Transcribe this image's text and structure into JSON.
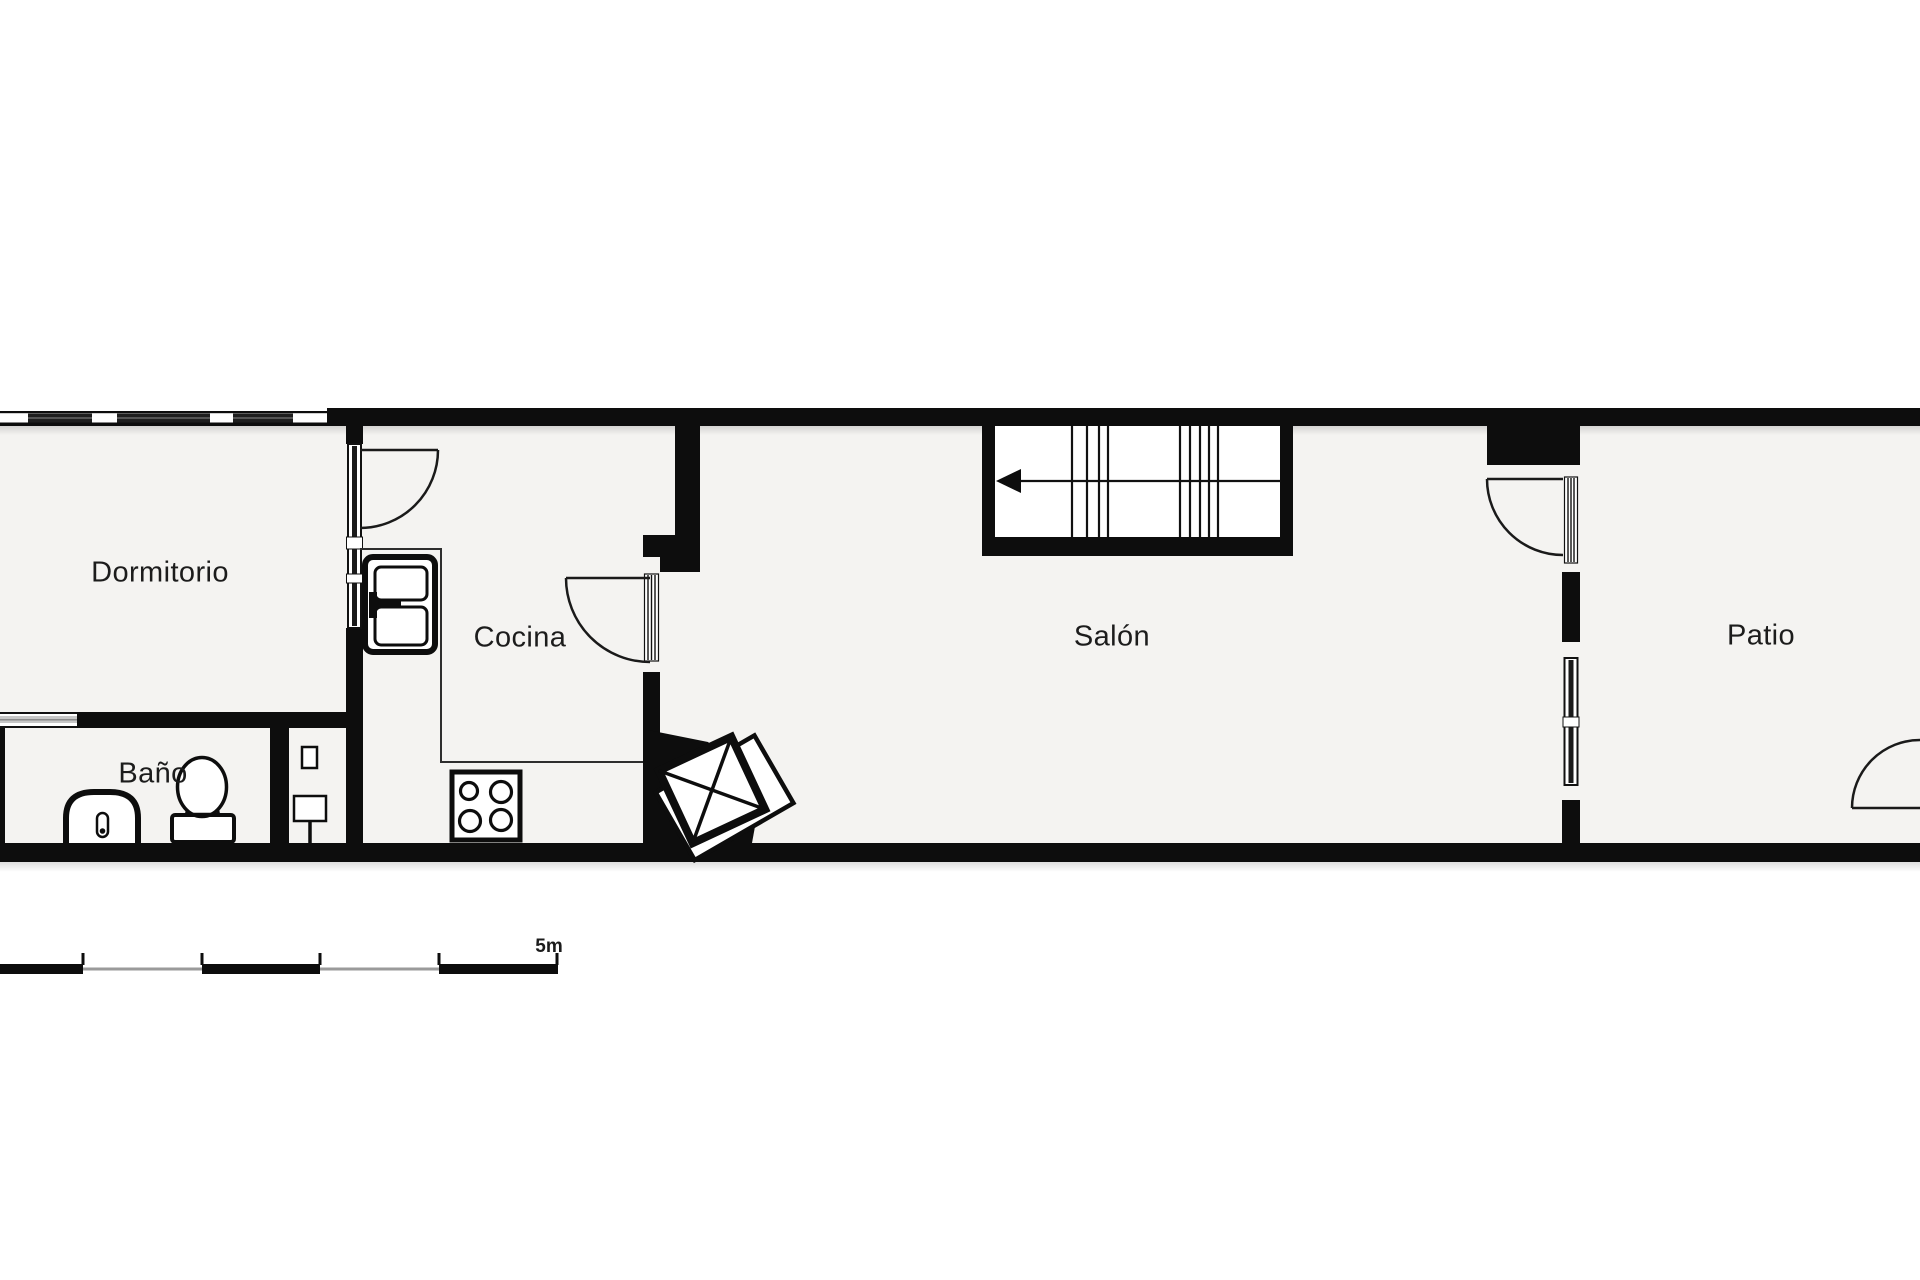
{
  "page": {
    "type": "floor-plan"
  },
  "rooms": [
    {
      "label": "Dormitorio"
    },
    {
      "label": "Baño"
    },
    {
      "label": "Cocina"
    },
    {
      "label": "Salón"
    },
    {
      "label": "Patio"
    }
  ],
  "scale_bar": {
    "label": "5m",
    "tick_count": 5
  },
  "fixtures": [
    "fridge",
    "stove-4-burner",
    "kitchen-counter",
    "toilet",
    "bidet",
    "shower-panel",
    "washing-machine-rotated",
    "staircase",
    "stairs-direction-arrow",
    "door-swing-cocina",
    "door-swing-salon",
    "door-swing-patio",
    "door-swing-patio-exterior",
    "window-band-top",
    "window-dormitorio-bano",
    "glazed-partition",
    "chimney-block"
  ],
  "colors": {
    "wall": "#0d0d0d",
    "floor": "#f4f3f1",
    "glazing_dark": "#1e1e1e",
    "window_light": "#c7c7c7",
    "scale_gray": "#9a9a9a",
    "text": "#1c1c1c"
  }
}
